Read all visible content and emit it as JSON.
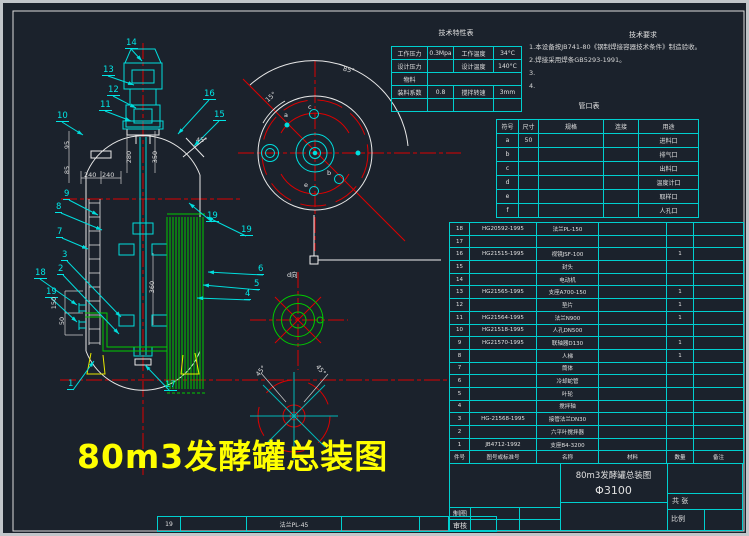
{
  "drawing_title_annotation": "80m3发酵罐总装图",
  "colors": {
    "background": "#1b222c",
    "line_white": "#e8e8e8",
    "line_cyan": "#00dddd",
    "line_red": "#dd0000",
    "line_green": "#00cc00",
    "line_yellow": "#e8e800",
    "table_cyan": "#00cfcf",
    "title_yellow": "#ffff00"
  },
  "notes": {
    "title": "技术要求",
    "lines": [
      "1.本设备按JB741-80《钢制焊接容器技术条件》制造验收。",
      "2.焊接采用焊条GB5293-1991。",
      "3.",
      "4."
    ]
  },
  "tech_table": {
    "title": "技术特性表",
    "rows": [
      [
        "工作压力",
        "0.3Mpa",
        "工作温度",
        "34°C"
      ],
      [
        "设计压力",
        "",
        "设计温度",
        "140°C"
      ],
      [
        "物料",
        "",
        "",
        ""
      ],
      [
        "装料系数",
        "0.8",
        "搅拌转速",
        "3mm"
      ],
      [
        "",
        "",
        "",
        ""
      ]
    ]
  },
  "nozzle_table": {
    "title": "管口表",
    "headers": [
      "符号",
      "尺寸",
      "规格",
      "连接",
      "用途"
    ],
    "rows": [
      [
        "a",
        "50",
        "",
        "",
        "进料口"
      ],
      [
        "b",
        "",
        "",
        "",
        "排气口"
      ],
      [
        "c",
        "",
        "",
        "",
        "出料口"
      ],
      [
        "d",
        "",
        "",
        "",
        "温度计口"
      ],
      [
        "e",
        "",
        "",
        "",
        "取样口"
      ],
      [
        "f",
        "",
        "",
        "",
        "人孔口"
      ]
    ]
  },
  "bom": {
    "headers": [
      "件号",
      "图号或标准号",
      "名称",
      "材料",
      "数量",
      "备注"
    ],
    "rows": [
      [
        "18",
        "HG20592-1995",
        "法兰PL-150",
        "",
        "",
        ""
      ],
      [
        "17",
        "",
        "",
        "",
        "",
        ""
      ],
      [
        "16",
        "HG21515-1995",
        "视镜JSF-100",
        "",
        "1",
        ""
      ],
      [
        "15",
        "",
        "封头",
        "",
        "",
        ""
      ],
      [
        "14",
        "",
        "电动机",
        "",
        "",
        ""
      ],
      [
        "13",
        "HG21565-1995",
        "支座A700-150",
        "",
        "1",
        ""
      ],
      [
        "12",
        "",
        "垫片",
        "",
        "1",
        ""
      ],
      [
        "11",
        "HG21564-1995",
        "法兰N900",
        "",
        "1",
        ""
      ],
      [
        "10",
        "HG21518-1995",
        "人孔DN500",
        "",
        "",
        ""
      ],
      [
        "9",
        "HG21570-1995",
        "联轴器D130",
        "",
        "1",
        ""
      ],
      [
        "8",
        "",
        "人梯",
        "",
        "1",
        ""
      ],
      [
        "7",
        "",
        "筒体",
        "",
        "",
        ""
      ],
      [
        "6",
        "",
        "冷却蛇管",
        "",
        "",
        ""
      ],
      [
        "5",
        "",
        "叶轮",
        "",
        "",
        ""
      ],
      [
        "4",
        "",
        "搅拌轴",
        "",
        "",
        ""
      ],
      [
        "3",
        "HG-21568-1995",
        "接管法兰DN30",
        "",
        "",
        ""
      ],
      [
        "2",
        "",
        "六平叶搅拌器",
        "",
        "",
        ""
      ],
      [
        "1",
        "JB4712-1992",
        "支座B4-3200",
        "",
        "",
        ""
      ]
    ]
  },
  "bottom_strip": {
    "cells": [
      "19",
      "",
      "法兰PL-45",
      "",
      "",
      ""
    ]
  },
  "title_block": {
    "name_line1": "80m3发酵罐总装图",
    "name_line2": "Φ3100",
    "draw_label": "制图",
    "check_label": "审核",
    "sheets_label": "共 张",
    "scale_label": "比例"
  },
  "balloons": [
    {
      "n": "14",
      "x": 122,
      "y": 36,
      "tx": 139,
      "ty": 58
    },
    {
      "n": "13",
      "x": 99,
      "y": 63,
      "tx": 131,
      "ty": 82
    },
    {
      "n": "12",
      "x": 104,
      "y": 83,
      "tx": 133,
      "ty": 105
    },
    {
      "n": "11",
      "x": 96,
      "y": 98,
      "tx": 128,
      "ty": 118
    },
    {
      "n": "10",
      "x": 53,
      "y": 109,
      "tx": 80,
      "ty": 132
    },
    {
      "n": "16",
      "x": 200,
      "y": 87,
      "tx": 175,
      "ty": 131
    },
    {
      "n": "15",
      "x": 210,
      "y": 108,
      "tx": 191,
      "ty": 143
    },
    {
      "n": "19",
      "x": 203,
      "y": 209,
      "tx": 186,
      "ty": 200
    },
    {
      "n": "19",
      "x": 237,
      "y": 223,
      "tx": 204,
      "ty": 214
    },
    {
      "n": "9",
      "x": 60,
      "y": 187,
      "tx": 95,
      "ty": 212
    },
    {
      "n": "8",
      "x": 52,
      "y": 200,
      "tx": 99,
      "ty": 227
    },
    {
      "n": "7",
      "x": 53,
      "y": 225,
      "tx": 85,
      "ty": 246
    },
    {
      "n": "3",
      "x": 58,
      "y": 248,
      "tx": 118,
      "ty": 314
    },
    {
      "n": "2",
      "x": 54,
      "y": 262,
      "tx": 116,
      "ty": 331
    },
    {
      "n": "18",
      "x": 31,
      "y": 266,
      "tx": 74,
      "ty": 302
    },
    {
      "n": "19",
      "x": 42,
      "y": 285,
      "tx": 74,
      "ty": 319
    },
    {
      "n": "6",
      "x": 254,
      "y": 262,
      "tx": 205,
      "ty": 269
    },
    {
      "n": "5",
      "x": 250,
      "y": 277,
      "tx": 200,
      "ty": 282
    },
    {
      "n": "4",
      "x": 241,
      "y": 287,
      "tx": 194,
      "ty": 295
    },
    {
      "n": "1",
      "x": 64,
      "y": 377,
      "tx": 91,
      "ty": 358
    },
    {
      "n": "17",
      "x": 161,
      "y": 378,
      "tx": 142,
      "ty": 362
    }
  ],
  "dimensions": [
    {
      "t": "280",
      "x": 120,
      "y": 150,
      "r": -90
    },
    {
      "t": "350",
      "x": 146,
      "y": 150,
      "r": -90
    },
    {
      "t": "240",
      "x": 81,
      "y": 168,
      "r": 0
    },
    {
      "t": "240",
      "x": 99,
      "y": 168,
      "r": 0
    },
    {
      "t": "95",
      "x": 60,
      "y": 138,
      "r": -90
    },
    {
      "t": "85",
      "x": 60,
      "y": 163,
      "r": -90
    },
    {
      "t": "360",
      "x": 143,
      "y": 280,
      "r": -90
    },
    {
      "t": "150",
      "x": 45,
      "y": 296,
      "r": -90
    },
    {
      "t": "50",
      "x": 55,
      "y": 314,
      "r": -90
    },
    {
      "t": "85°",
      "x": 340,
      "y": 63,
      "r": 14
    },
    {
      "t": "15°",
      "x": 262,
      "y": 90,
      "r": -42
    },
    {
      "t": "45°",
      "x": 193,
      "y": 133,
      "r": 0
    },
    {
      "t": "45°",
      "x": 252,
      "y": 364,
      "r": -50
    },
    {
      "t": "45°",
      "x": 312,
      "y": 363,
      "r": 50
    }
  ],
  "view_letters": [
    {
      "t": "a",
      "x": 281,
      "y": 108
    },
    {
      "t": "c",
      "x": 305,
      "y": 100
    },
    {
      "t": "b",
      "x": 324,
      "y": 166
    },
    {
      "t": "e",
      "x": 301,
      "y": 178
    },
    {
      "t": "d向",
      "x": 284,
      "y": 266
    }
  ]
}
